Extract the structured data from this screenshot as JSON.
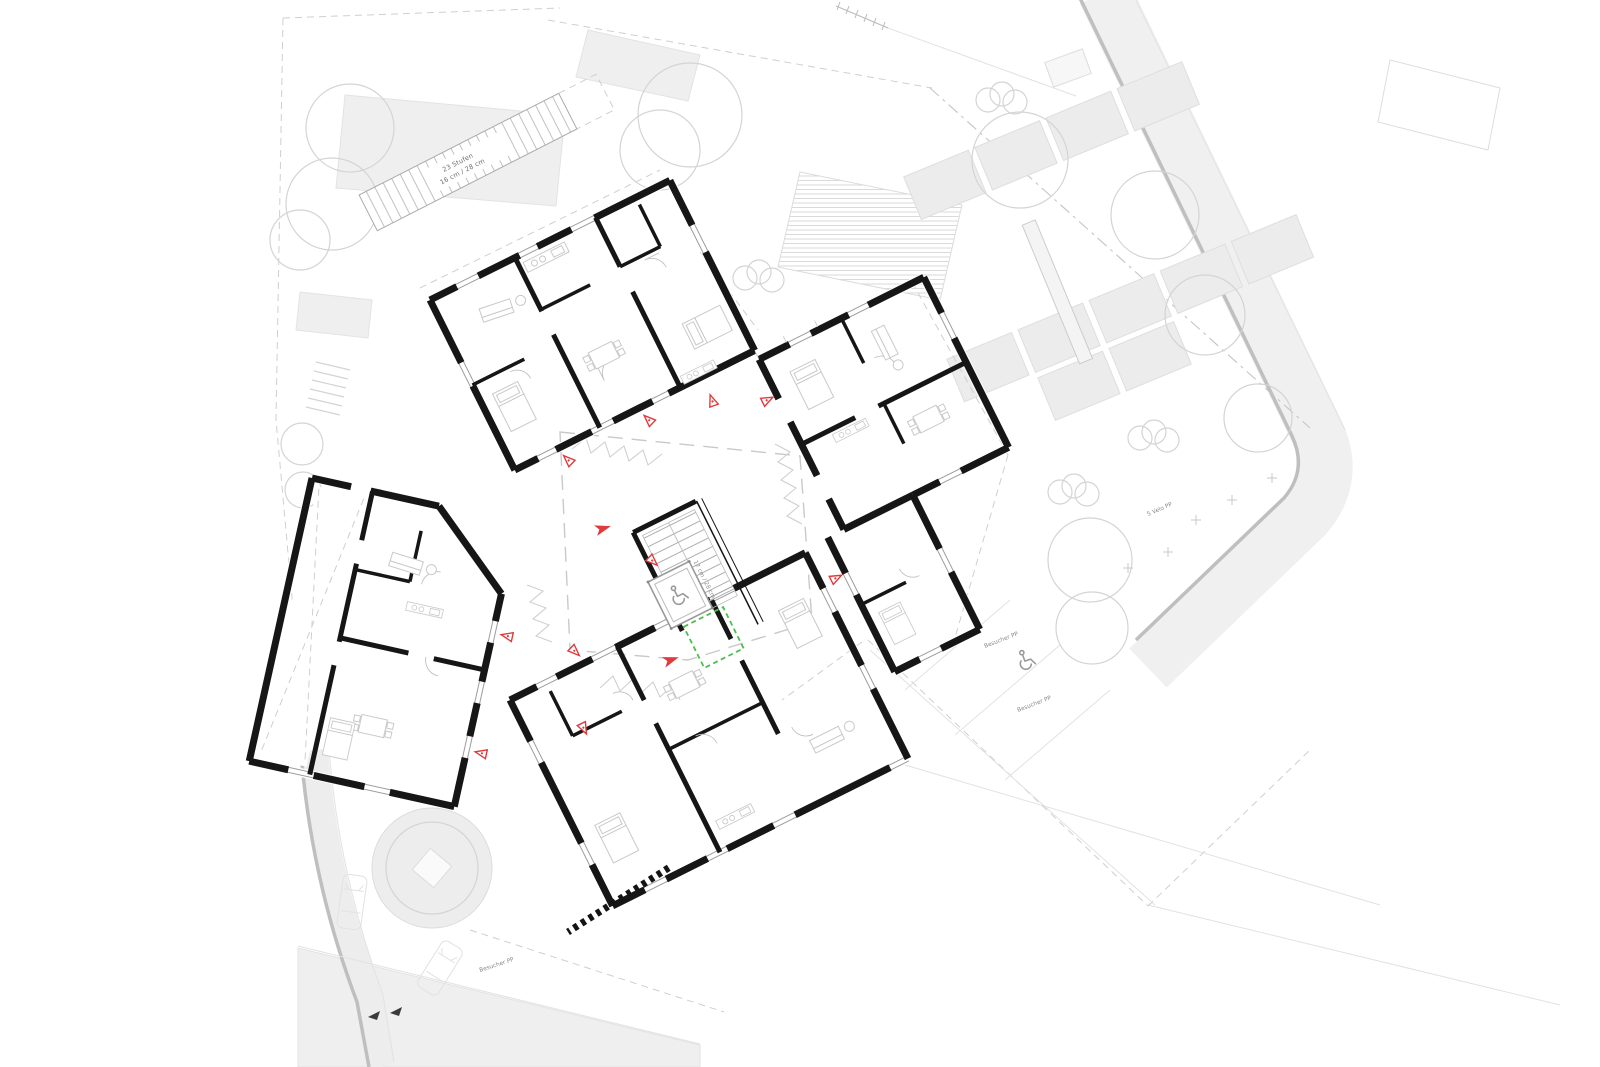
{
  "plan": {
    "type": "architectural-site-and-floor-plan",
    "labels": {
      "outdoor_stair": {
        "line1": "23 Stufen",
        "line2": "16 cm / 28 cm"
      },
      "indoor_stair": {
        "line1": "17 Stufen",
        "line2": "17 cm / 28 cm"
      },
      "visitor_parking_upper": "Besucher PP",
      "visitor_parking_lower": "Besucher PP",
      "visitor_parking_south": "Besucher PP",
      "bike_parking": "5 Velo PP"
    },
    "colors": {
      "wall": "#161616",
      "entrance_arrow_red": "#e03a3c",
      "highlight_green": "#4bbf4e",
      "site_gray": "#efefef",
      "line_gray": "#c9c9c9",
      "road_edge_gray": "#bfbfbf"
    },
    "icons": {
      "wheelchair_elevator": "wheelchair accessibility symbol in elevator",
      "wheelchair_parking": "wheelchair accessibility symbol on visitor parking",
      "north_markers": "two small black site orientation triangles"
    }
  }
}
